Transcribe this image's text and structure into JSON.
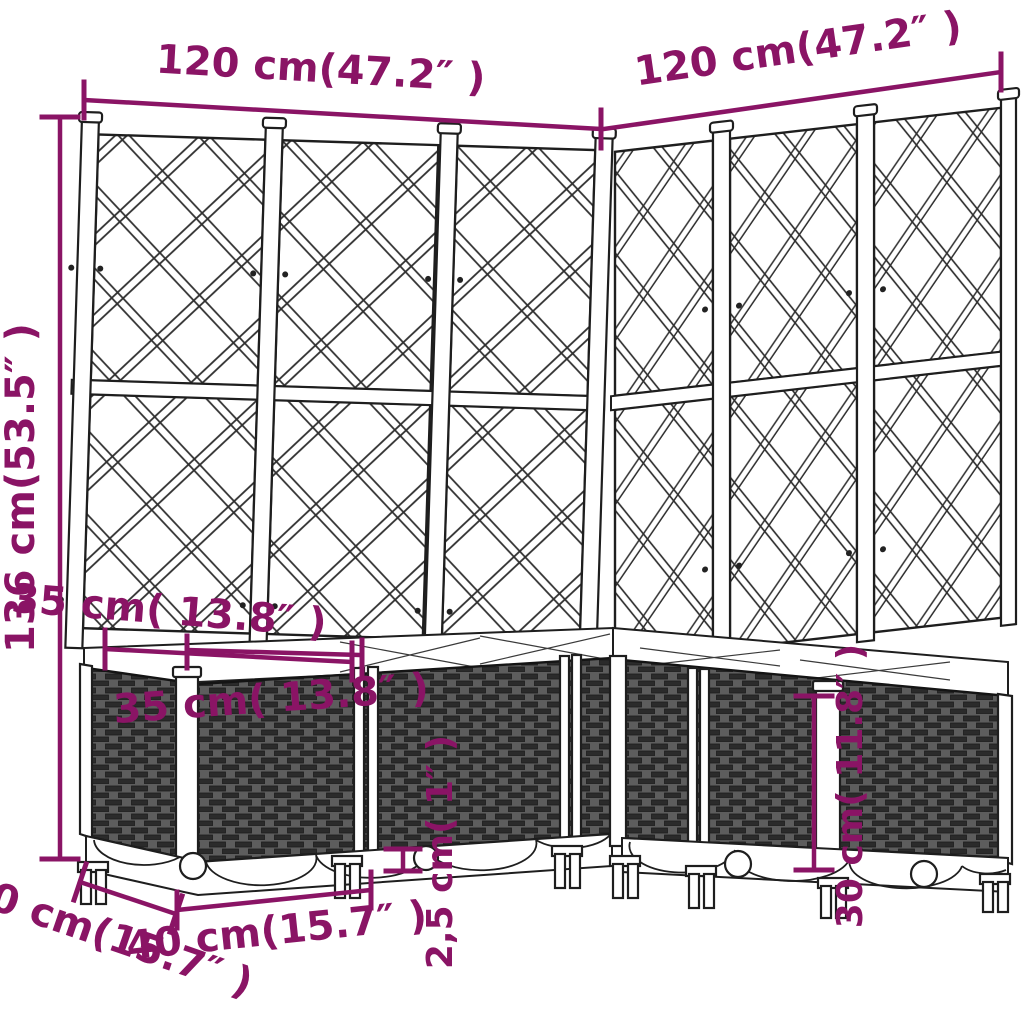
{
  "diagram": {
    "kind": "product dimension line-drawing",
    "subject": "corner garden planter with trellis",
    "colors": {
      "dimension_accent": "#8A1465",
      "outline": "#1E1E1E",
      "weave_base": "#5D5D5D",
      "weave_brick": "#2B2B2B",
      "background": "#FFFFFF"
    },
    "dimensions": {
      "top_width_left": "120 cm(47.2″ )",
      "top_width_right": "120 cm(47.2″ )",
      "total_height": "136 cm(53.5″ )",
      "planter_depth_outer": "35 cm( 13.8″ )",
      "planter_depth_inner": "35 cm( 13.8″ )",
      "base_depth": "40 cm(15.7″ )",
      "module_width": "40 cm(15.7″ )",
      "foot_height": "2,5 cm( 1″ )",
      "box_height": "30 cm( 11.8″ )"
    }
  }
}
